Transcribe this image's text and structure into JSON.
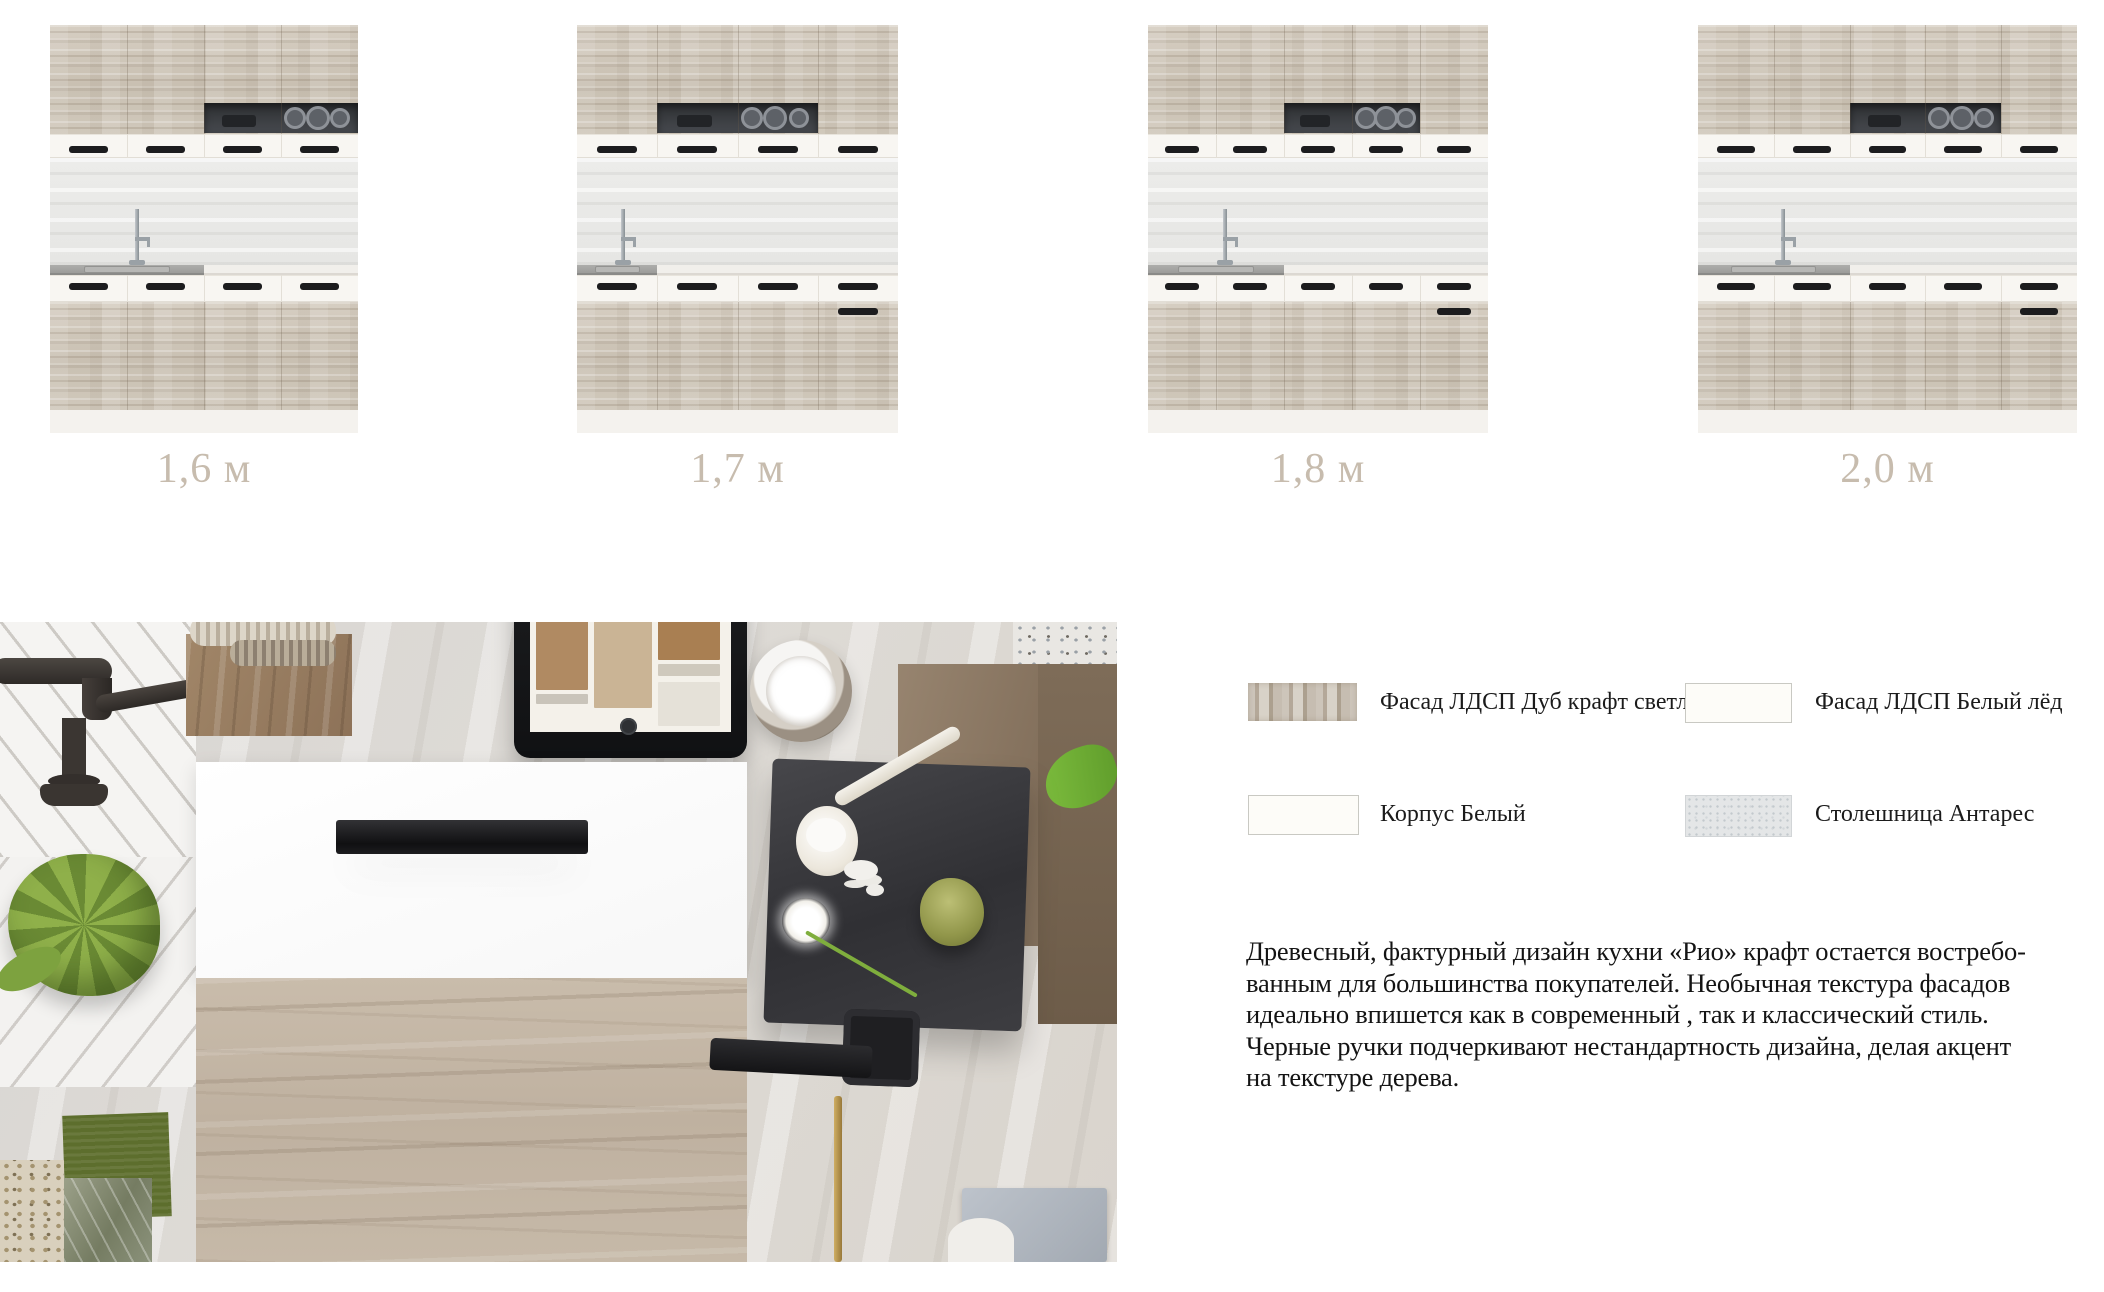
{
  "sizes": {
    "items": [
      {
        "label": "1,6 м",
        "cabinet_columns": 4,
        "niche_from_col": 3,
        "niche_to_col": 4,
        "sink_columns": 2,
        "tall_drawer_last_column": false
      },
      {
        "label": "1,7 м",
        "cabinet_columns": 4,
        "niche_from_col": 2,
        "niche_to_col": 3,
        "sink_columns": 1,
        "tall_drawer_last_column": true
      },
      {
        "label": "1,8 м",
        "cabinet_columns": 5,
        "niche_from_col": 3,
        "niche_to_col": 4,
        "sink_columns": 2,
        "tall_drawer_last_column": true
      },
      {
        "label": "2,0 м",
        "cabinet_columns": 5,
        "niche_from_col": 3,
        "niche_to_col": 4,
        "sink_columns": 2,
        "tall_drawer_last_column": true
      }
    ]
  },
  "materials": {
    "items": [
      {
        "label": "Фасад ЛДСП Дуб крафт светл.",
        "swatch": "oak-craft"
      },
      {
        "label": "Фасад ЛДСП Белый лёд",
        "swatch": "white-ice"
      },
      {
        "label": "Корпус Белый",
        "swatch": "white-body"
      },
      {
        "label": "Столешница Антарес",
        "swatch": "antares"
      }
    ]
  },
  "description": {
    "text": "Древесный, фактурный дизайн кухни «Рио» крафт остается востребо-\nванным для большинства покупателей. Необычная текстура фасадов\nидеально впишется как в современный , так и классический стиль.\nЧерные ручки подчеркивают нестандартность  дизайна, делая акцент\nна текстуре дерева."
  },
  "colors": {
    "size_label": "#c7bcae",
    "handle_black": "#1c1c1e",
    "facade_wood": "#cdc5b8",
    "counter_gray": "#a3a3a1",
    "text": "#141414"
  }
}
